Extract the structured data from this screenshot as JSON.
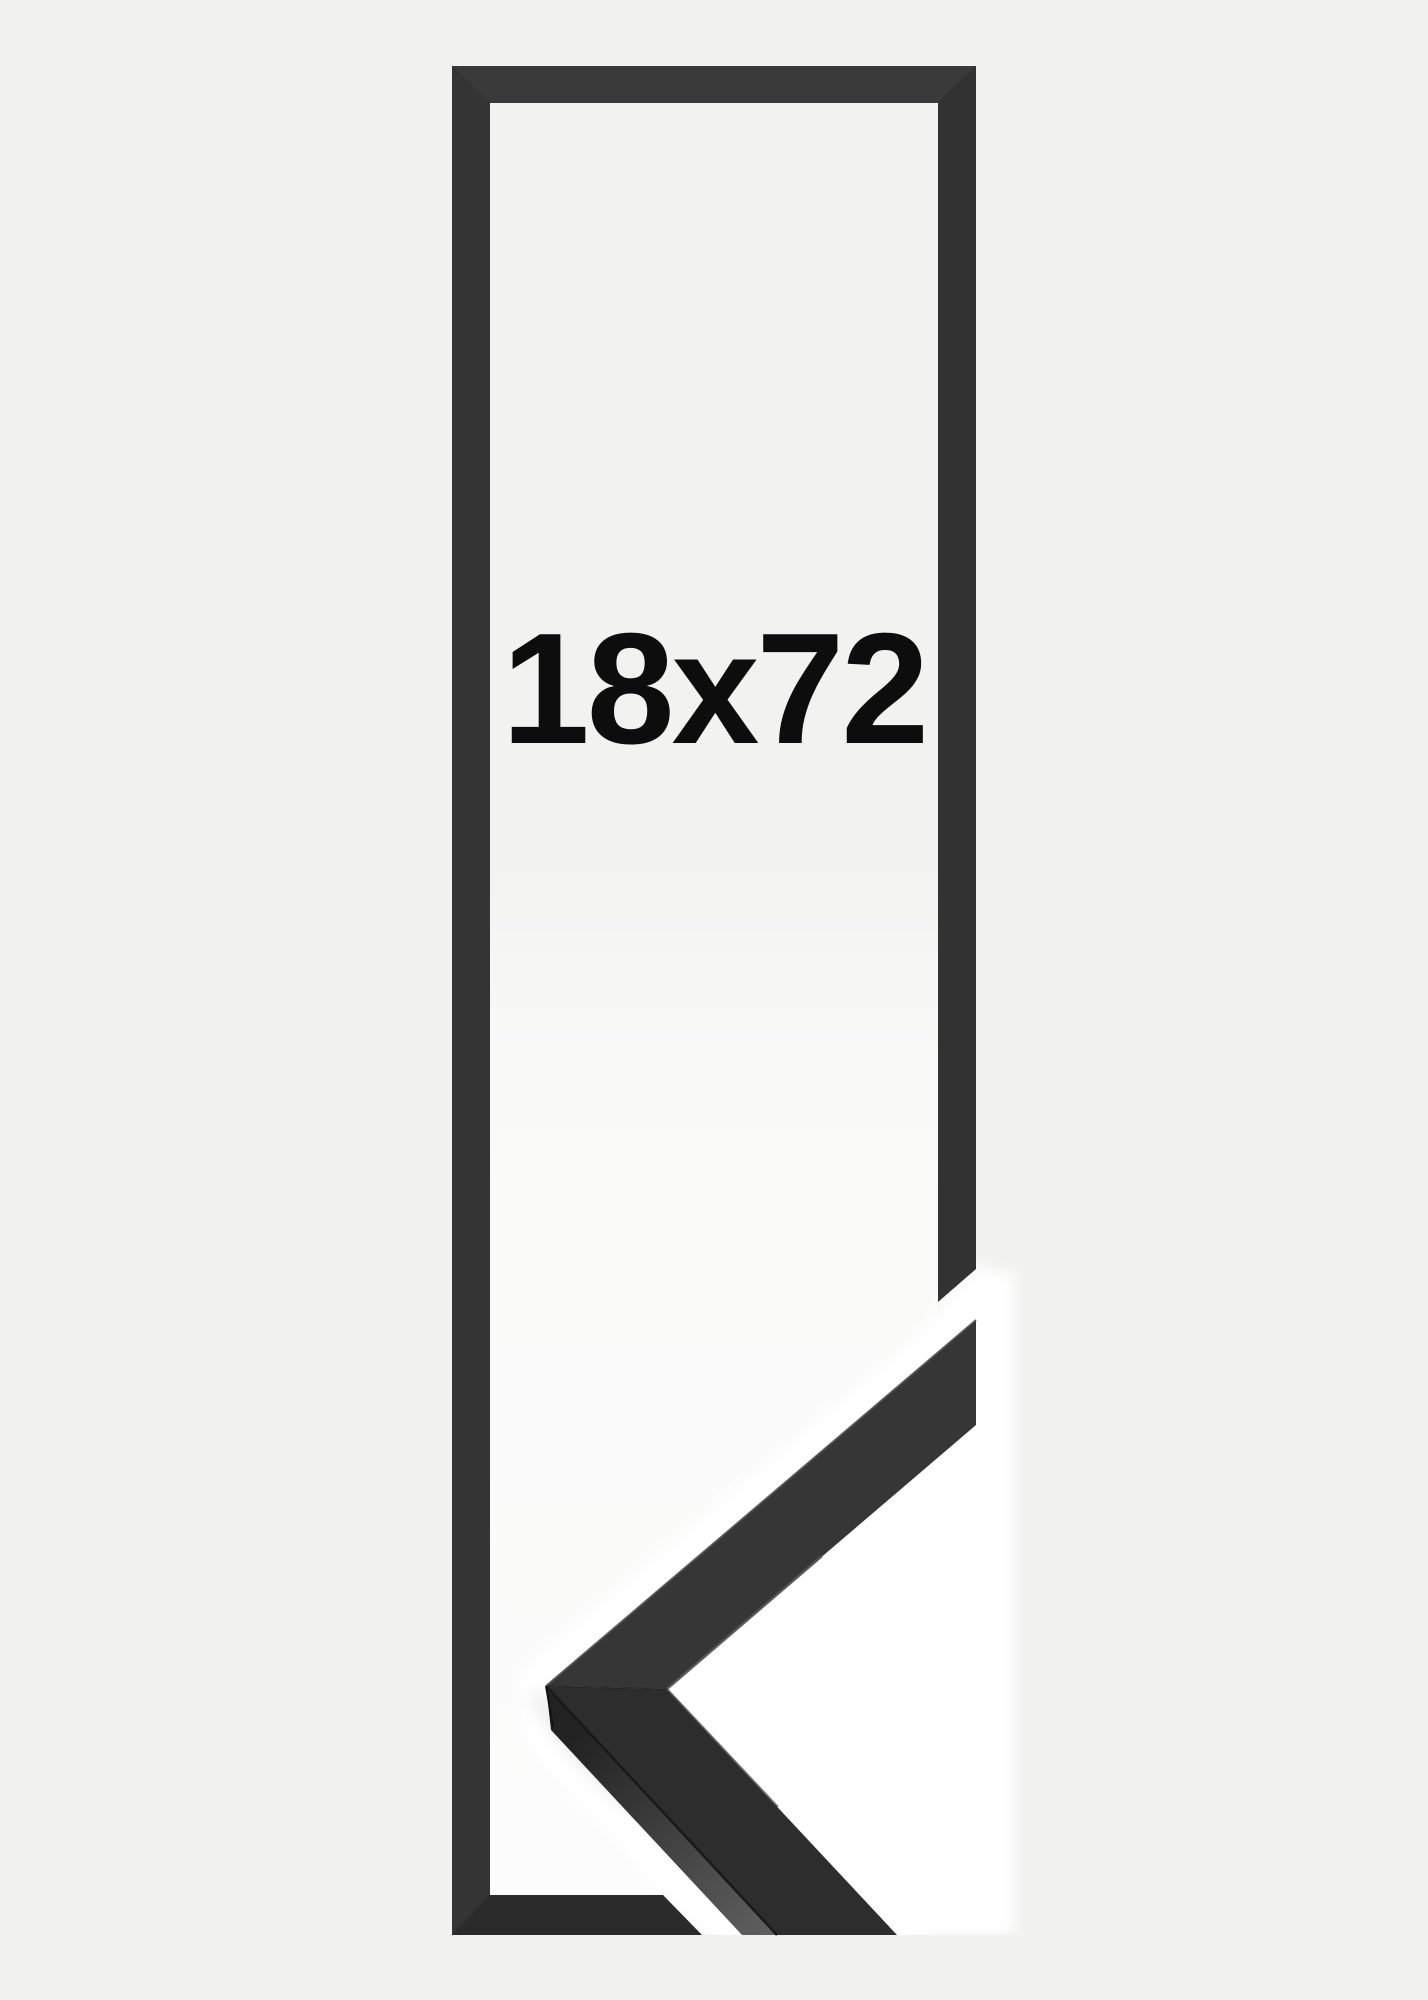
{
  "product": {
    "size_label": "18x72"
  },
  "colors": {
    "background": "#f1f1f0",
    "interior_top": "#f2f2f1",
    "interior_mid": "#f9f9f8",
    "interior_bottom": "#fcfcfc",
    "photo_background": "#ffffff",
    "bar_top": "#3a3a3a",
    "bar_left": "#343434",
    "bar_right": "#323232",
    "bar_bottom": "#2b2b2b",
    "moulding_face_upper": "#363636",
    "moulding_face_lower": "#2d2d2d",
    "moulding_side_near": "#222222",
    "moulding_side_far": "#5e5e5e",
    "moulding_crease": "#191919",
    "edge_highlight": "#4d4d4d",
    "inner_lip_upper": "#575757",
    "inner_lip_lower": "#4e4e4e",
    "label": "#0d0d0d"
  }
}
